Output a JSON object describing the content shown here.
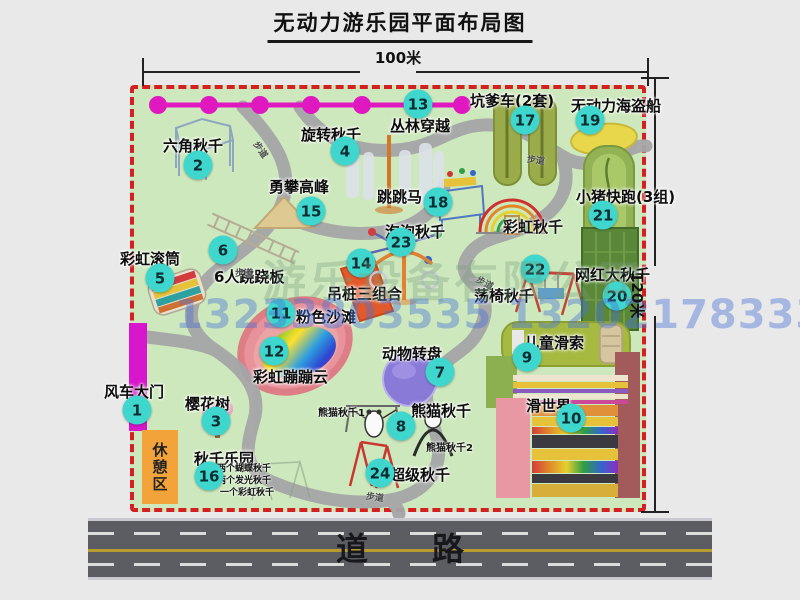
{
  "title": "无动力游乐园平面布局图",
  "dimension": {
    "top": "100米",
    "right": "120米"
  },
  "road": {
    "label": "道　　路"
  },
  "watermark": {
    "company": "游乐设备有限公司",
    "phone": "13233803535 13202178333"
  },
  "rest_area": {
    "label": "休憩区"
  },
  "colors": {
    "park_green": "#cde8bc",
    "border_red": "#d42020",
    "badge_teal": "#3fd6cd",
    "path_gray": "#a5a5a7",
    "chain_magenta": "#e018c0",
    "gate_magenta": "#d816cc",
    "rest_orange": "#f2a43a",
    "road_gray": "#5c5c63"
  },
  "attractions": [
    {
      "num": "1",
      "name": "风车大门",
      "slug": "windmill-gate",
      "lx": 104,
      "ly": 381,
      "bx": 137,
      "by": 410
    },
    {
      "num": "2",
      "name": "六角秋千",
      "slug": "hexagon-swing",
      "lx": 163,
      "ly": 135,
      "bx": 198,
      "by": 165
    },
    {
      "num": "3",
      "name": "樱花树",
      "slug": "cherry-tree",
      "lx": 185,
      "ly": 393,
      "bx": 216,
      "by": 421
    },
    {
      "num": "4",
      "name": "旋转秋千",
      "slug": "rotating-swing",
      "lx": 301,
      "ly": 124,
      "bx": 345,
      "by": 151
    },
    {
      "num": "5",
      "name": "彩虹滚筒",
      "slug": "rainbow-roller",
      "lx": 120,
      "ly": 248,
      "bx": 160,
      "by": 278
    },
    {
      "num": "6",
      "name": "6人跷跷板",
      "slug": "six-person-seesaw",
      "lx": 214,
      "ly": 266,
      "bx": 223,
      "by": 250
    },
    {
      "num": "7",
      "name": "动物转盘",
      "slug": "animal-turntable",
      "lx": 382,
      "ly": 343,
      "bx": 440,
      "by": 372
    },
    {
      "num": "8",
      "name": "熊猫秋千",
      "slug": "panda-swing",
      "lx": 411,
      "ly": 400,
      "bx": 401,
      "by": 426
    },
    {
      "num": "9",
      "name": "儿童滑索",
      "slug": "kids-zipline",
      "lx": 524,
      "ly": 332,
      "bx": 527,
      "by": 357
    },
    {
      "num": "10",
      "name": "滑世界",
      "slug": "slide-world",
      "lx": 526,
      "ly": 395,
      "bx": 571,
      "by": 418
    },
    {
      "num": "11",
      "name": "粉色沙滩",
      "slug": "pink-beach",
      "lx": 296,
      "ly": 306,
      "bx": 281,
      "by": 313
    },
    {
      "num": "12",
      "name": "彩虹蹦蹦云",
      "slug": "rainbow-cloud",
      "lx": 253,
      "ly": 366,
      "bx": 274,
      "by": 351
    },
    {
      "num": "13",
      "name": "丛林穿越",
      "slug": "jungle-crossing",
      "lx": 390,
      "ly": 115,
      "bx": 418,
      "by": 104
    },
    {
      "num": "14",
      "name": "吊桩三组合",
      "slug": "hanging-piles",
      "lx": 327,
      "ly": 283,
      "bx": 361,
      "by": 263
    },
    {
      "num": "15",
      "name": "勇攀高峰",
      "slug": "climb-peak",
      "lx": 269,
      "ly": 176,
      "bx": 311,
      "by": 211
    },
    {
      "num": "16",
      "name": "秋千乐园",
      "slug": "swing-park",
      "lx": 194,
      "ly": 448,
      "bx": 209,
      "by": 476
    },
    {
      "num": "17",
      "name": "坑爹车(2套)",
      "slug": "pit-car",
      "lx": 470,
      "ly": 90,
      "bx": 525,
      "by": 120
    },
    {
      "num": "18",
      "name": "跳跳马",
      "slug": "jump-horse",
      "lx": 377,
      "ly": 186,
      "bx": 438,
      "by": 202
    },
    {
      "num": "19",
      "name": "无动力海盗船",
      "slug": "pirate-ship",
      "lx": 571,
      "ly": 95,
      "bx": 590,
      "by": 120
    },
    {
      "num": "20",
      "name": "网红大秋千",
      "slug": "big-swing",
      "lx": 575,
      "ly": 264,
      "bx": 617,
      "by": 296
    },
    {
      "num": "21",
      "name": "小猪快跑(3组)",
      "slug": "piggy-run",
      "lx": 576,
      "ly": 186,
      "bx": 603,
      "by": 215
    },
    {
      "num": "22",
      "name": "荡椅秋千",
      "slug": "swing-chair",
      "lx": 474,
      "ly": 285,
      "bx": 535,
      "by": 269
    },
    {
      "num": "23",
      "name": "泡泡秋千",
      "slug": "bubble-swing",
      "lx": 385,
      "ly": 221,
      "bx": 401,
      "by": 242
    },
    {
      "num": "24",
      "name": "超级秋千",
      "slug": "super-swing",
      "lx": 390,
      "ly": 464,
      "bx": 380,
      "by": 473
    }
  ],
  "extra_texts": [
    {
      "text": "彩虹秋千",
      "slug": "rainbow-swing-label",
      "x": 503,
      "y": 216,
      "size": 15
    },
    {
      "text": "熊猫秋千1",
      "slug": "panda-swing-1-label",
      "x": 318,
      "y": 404,
      "size": 10
    },
    {
      "text": "熊猫秋千2",
      "slug": "panda-swing-2-label",
      "x": 426,
      "y": 439,
      "size": 10
    },
    {
      "text": "两个蝴蝶秋千",
      "slug": "swing-park-note-1",
      "x": 217,
      "y": 461,
      "size": 9
    },
    {
      "text": "两个发光秋千",
      "slug": "swing-park-note-2",
      "x": 217,
      "y": 473,
      "size": 9
    },
    {
      "text": "一个彩虹秋千",
      "slug": "swing-park-note-3",
      "x": 220,
      "y": 485,
      "size": 9
    }
  ],
  "trail_labels": [
    {
      "text": "步道",
      "x": 252,
      "y": 143,
      "rot": 55
    },
    {
      "text": "步道",
      "x": 527,
      "y": 153,
      "rot": 8
    },
    {
      "text": "步道",
      "x": 235,
      "y": 266,
      "rot": 0
    },
    {
      "text": "步道",
      "x": 476,
      "y": 276,
      "rot": 28
    },
    {
      "text": "步道",
      "x": 366,
      "y": 490,
      "rot": 8
    }
  ]
}
